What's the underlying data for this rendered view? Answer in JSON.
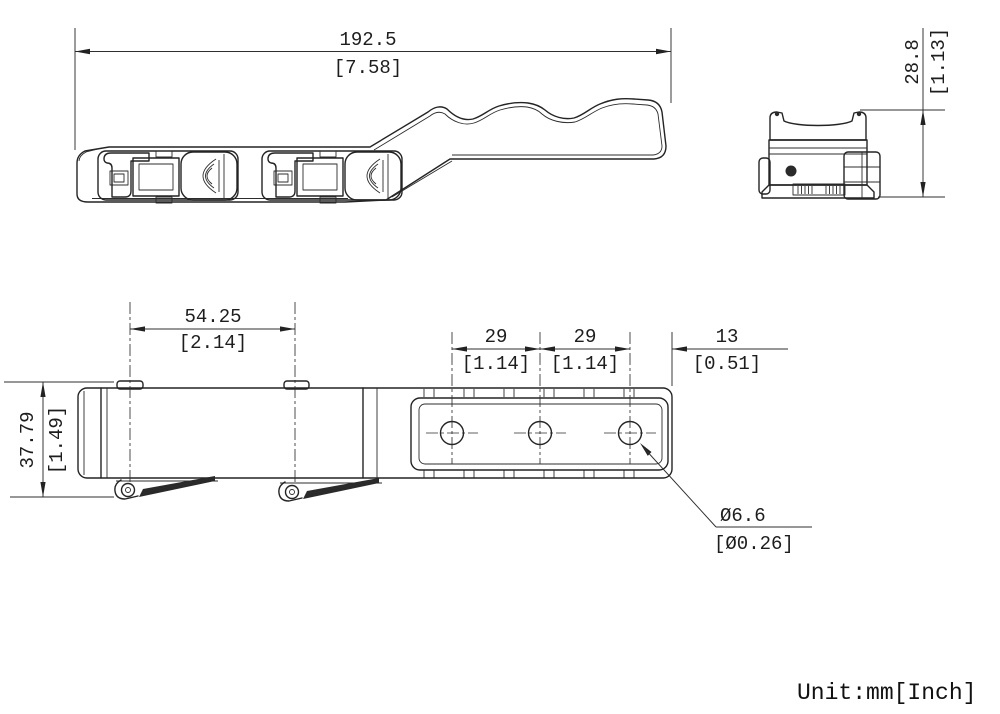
{
  "dims": {
    "overall_length": {
      "mm": "192.5",
      "inch": "[7.58]"
    },
    "side_height": {
      "mm": "28.8",
      "inch": "[1.13]"
    },
    "lug_spacing": {
      "mm": "54.25",
      "inch": "[2.14]"
    },
    "hole_pitch_a": {
      "mm": "29",
      "inch": "[1.14]"
    },
    "hole_pitch_b": {
      "mm": "29",
      "inch": "[1.14]"
    },
    "end_offset": {
      "mm": "13",
      "inch": "[0.51]"
    },
    "overall_width": {
      "mm": "37.79",
      "inch": "[1.49]"
    },
    "hole_diameter": {
      "mm": "Ø6.6",
      "inch": "[Ø0.26]"
    }
  },
  "note": {
    "units": "Unit:mm[Inch]"
  }
}
